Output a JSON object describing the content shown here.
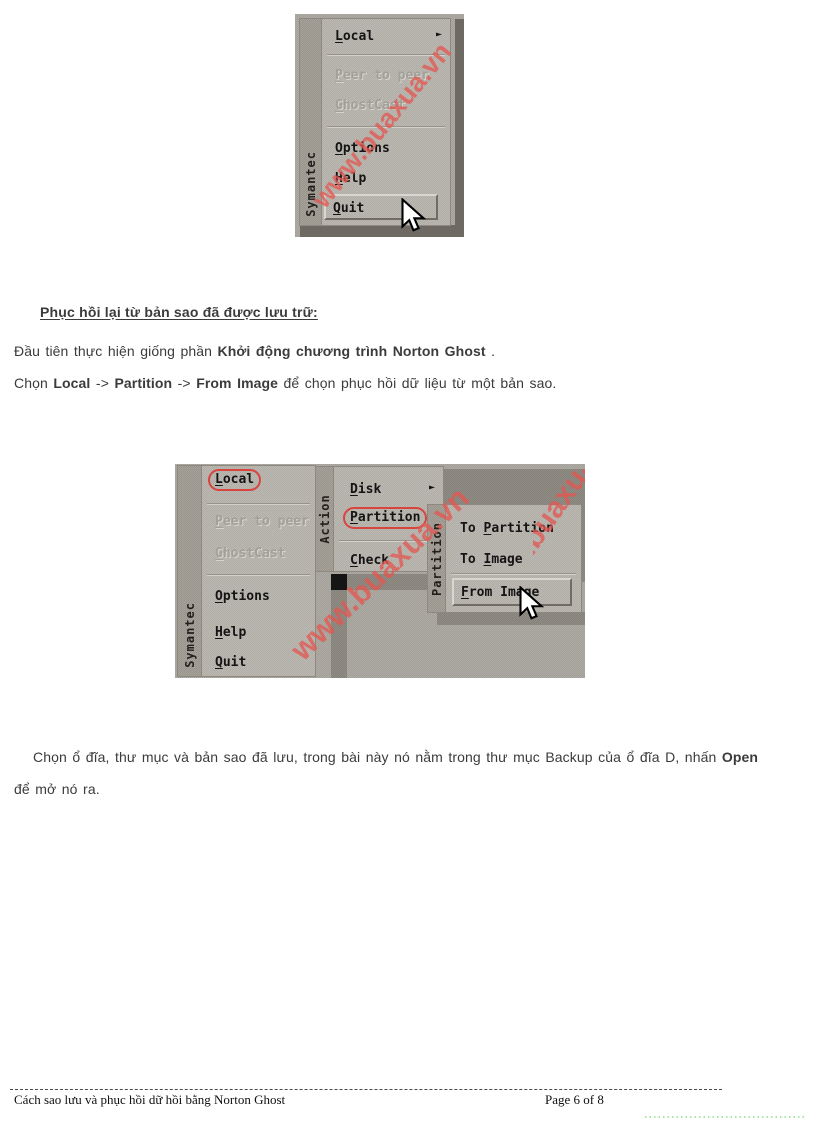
{
  "brand": "Symantec",
  "watermark": "www.buaxua.vn",
  "icons": {
    "submenu_arrow": "►",
    "mouse_cursor": "arrow-pointer"
  },
  "colors": {
    "highlight_red": "#d8453e",
    "watermark_red": "#e2584e",
    "menu_panel_gray": "#b7b3ad",
    "menu_strip_gray": "#a09b93",
    "shadow_gray": "#8b8780",
    "footer_dots_green": "#a9e7a9"
  },
  "shot1": {
    "menu_items": [
      {
        "label": "Local",
        "hotkey": "L",
        "arrow": true
      },
      {
        "separator": true
      },
      {
        "label": "Peer to peer",
        "hotkey": "P",
        "disabled": true
      },
      {
        "label": "GhostCast",
        "hotkey": "G",
        "disabled": true
      },
      {
        "separator": true
      },
      {
        "label": "Options",
        "hotkey": "O"
      },
      {
        "label": "Help",
        "hotkey": "H"
      },
      {
        "label": "Quit",
        "hotkey": "Q",
        "button": true
      }
    ]
  },
  "shot2": {
    "action_label": "Action",
    "partition_label": "Partition",
    "local_menu_items": [
      {
        "label": "Local",
        "hotkey": "L",
        "circled": true
      },
      {
        "separator": true
      },
      {
        "label": "Peer to peer",
        "hotkey": "P",
        "disabled": true
      },
      {
        "label": "GhostCast",
        "hotkey": "G",
        "disabled": true
      },
      {
        "separator": true
      },
      {
        "label": "Options",
        "hotkey": "O"
      },
      {
        "label": "Help",
        "hotkey": "H"
      },
      {
        "label": "Quit",
        "hotkey": "Q"
      }
    ],
    "action_menu_items": [
      {
        "label": "Disk",
        "hotkey": "D",
        "arrow": true
      },
      {
        "label": "Partition",
        "hotkey": "P",
        "circled": true
      },
      {
        "separator": true
      },
      {
        "label": "Check",
        "hotkey": "C"
      }
    ],
    "partition_menu_items": [
      {
        "label": "To Partition",
        "hotkey": "P"
      },
      {
        "label": "To Image",
        "hotkey": "I"
      },
      {
        "separator": true
      },
      {
        "label": "From Image",
        "hotkey": "F",
        "button": true
      }
    ]
  },
  "content": {
    "heading": "Phục hồi lại từ bản sao đã được lưu trữ:",
    "p1_segments": [
      {
        "text": "Đầu tiên thực hiện giống phần ",
        "bold": false
      },
      {
        "text": "Khởi động chương trình Norton Ghost",
        "bold": true
      },
      {
        "text": " .",
        "bold": false
      }
    ],
    "p2_segments": [
      {
        "text": "Chọn ",
        "bold": false
      },
      {
        "text": "Local",
        "bold": true
      },
      {
        "text": " -> ",
        "bold": false
      },
      {
        "text": "Partition",
        "bold": true
      },
      {
        "text": " -> ",
        "bold": false
      },
      {
        "text": "From Image",
        "bold": true
      },
      {
        "text": " để chọn phục hồi dữ liệu từ một bản sao.",
        "bold": false
      }
    ],
    "p3_segments": [
      {
        "text": "Chọn ổ đĩa, thư mục và bản sao đã lưu, trong bài này nó nằm trong thư mục Backup của ổ đĩa D, nhấn ",
        "bold": false
      },
      {
        "text": "Open",
        "bold": true
      },
      {
        "text": " để mở nó ra.",
        "bold": false
      }
    ]
  },
  "footer": {
    "doc_title": "Cách sao lưu và phục hồi dữ hồi bằng Norton Ghost",
    "page_info": "Page 6 of 8"
  }
}
